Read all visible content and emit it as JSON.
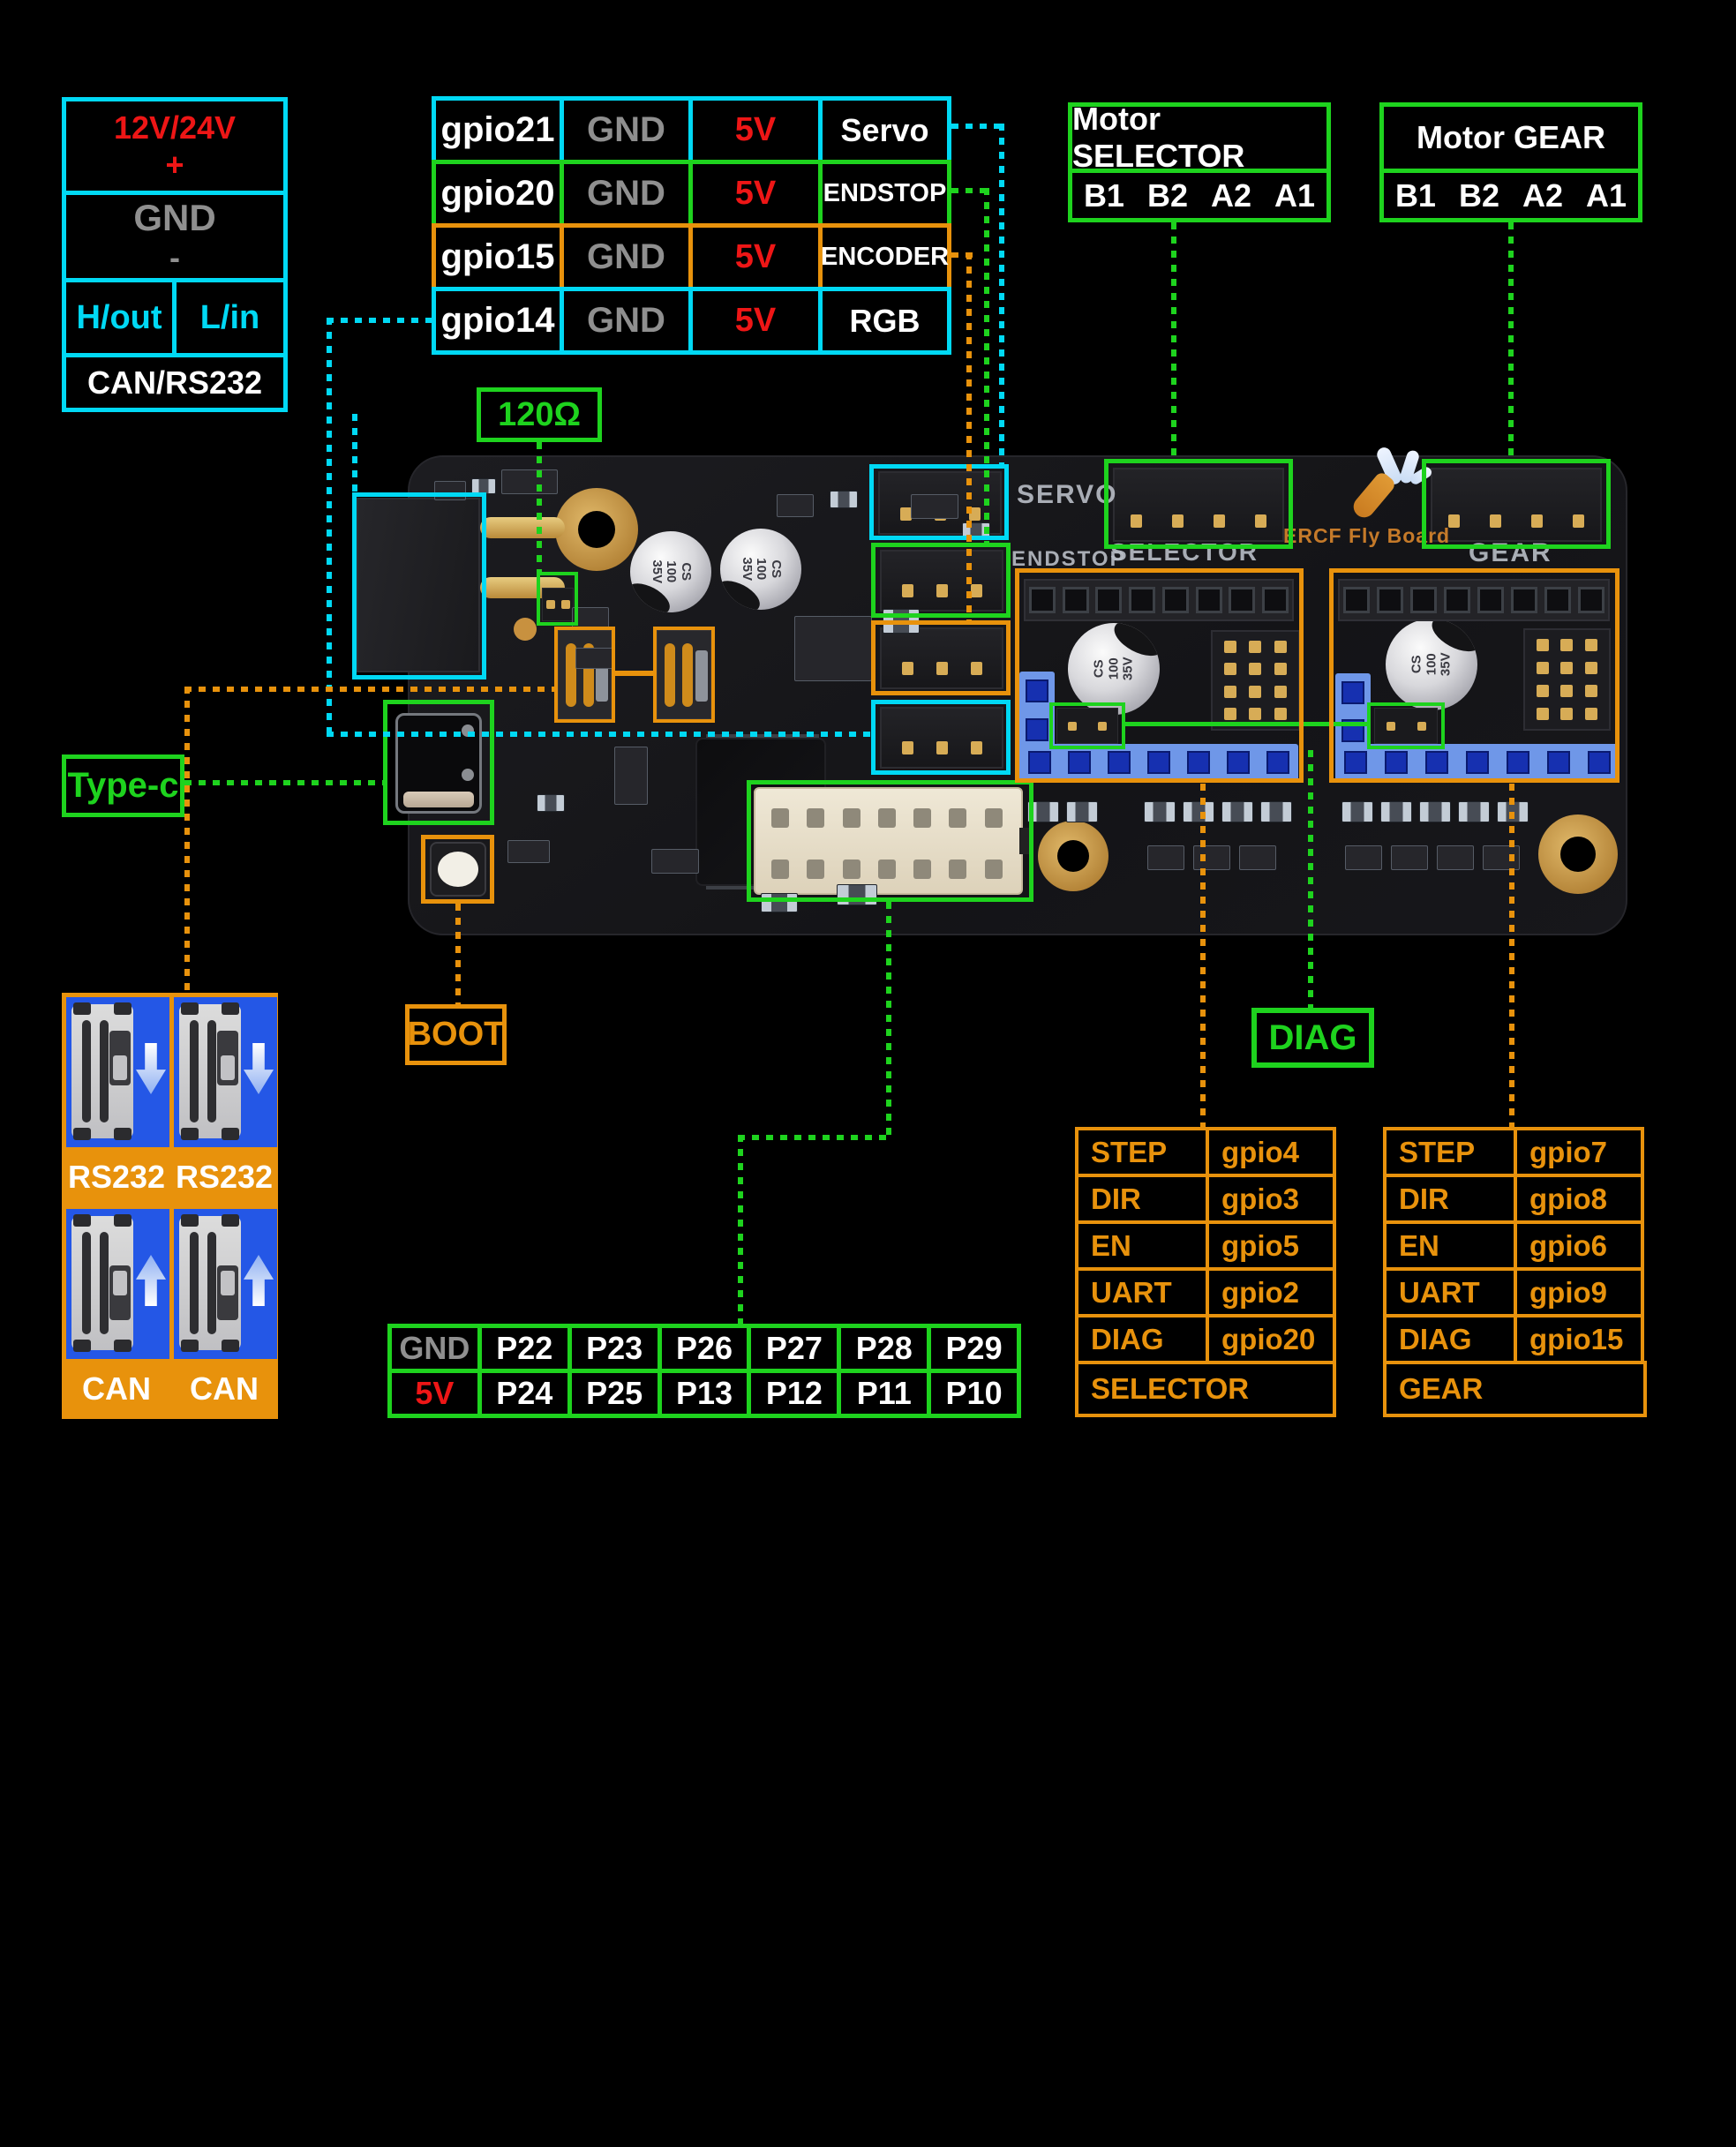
{
  "colors": {
    "cyan": "#00d9f5",
    "green": "#1ed31e",
    "orange": "#e8920c",
    "red": "#ee1616",
    "gray": "#8f8f8f",
    "gold": "#d7ac56",
    "blue-header": "#6f97e8",
    "blue-hole": "#1630b0",
    "panel-blue": "#2457e6",
    "silk": "#b9bec6",
    "brand-orange": "#d9862c"
  },
  "power_box": {
    "voltage": "12V/24V",
    "plus": "+",
    "ground": "GND",
    "minus": "-",
    "high_out": "H/out",
    "low_in": "L/in",
    "protocol": "CAN/RS232"
  },
  "gpio_table": {
    "rows": [
      {
        "gpio": "gpio21",
        "gnd": "GND",
        "v5": "5V",
        "label": "Servo"
      },
      {
        "gpio": "gpio20",
        "gnd": "GND",
        "v5": "5V",
        "label": "ENDSTOP"
      },
      {
        "gpio": "gpio15",
        "gnd": "GND",
        "v5": "5V",
        "label": "ENCODER"
      },
      {
        "gpio": "gpio14",
        "gnd": "GND",
        "v5": "5V",
        "label": "RGB"
      }
    ]
  },
  "motor_selector": {
    "title": "Motor SELECTOR",
    "pins": [
      "B1",
      "B2",
      "A2",
      "A1"
    ]
  },
  "motor_gear": {
    "title": "Motor GEAR",
    "pins": [
      "B1",
      "B2",
      "A2",
      "A1"
    ]
  },
  "callouts": {
    "termination": "120Ω",
    "typec": "Type-c",
    "boot": "BOOT",
    "diag": "DIAG"
  },
  "silkscreen": {
    "servo": "SERVO",
    "endstop": "ENDSTOP",
    "selector": "SELECTOR",
    "gear": "GEAR",
    "brand": "ERCF Fly Board",
    "cap_lines": [
      "CS",
      "100",
      "35V"
    ]
  },
  "comm_panel": {
    "top_labels": [
      "RS232",
      "RS232"
    ],
    "bottom_labels": [
      "CAN",
      "CAN"
    ]
  },
  "aux_pin_table": {
    "row1": [
      "GND",
      "P22",
      "P23",
      "P26",
      "P27",
      "P28",
      "P29"
    ],
    "row2": [
      "5V",
      "P24",
      "P25",
      "P13",
      "P12",
      "P11",
      "P10"
    ]
  },
  "selector_table": {
    "rows": [
      {
        "signal": "STEP",
        "pin": "gpio4"
      },
      {
        "signal": "DIR",
        "pin": "gpio3"
      },
      {
        "signal": "EN",
        "pin": "gpio5"
      },
      {
        "signal": "UART",
        "pin": "gpio2"
      },
      {
        "signal": "DIAG",
        "pin": "gpio20"
      }
    ],
    "footer": "SELECTOR"
  },
  "gear_table": {
    "rows": [
      {
        "signal": "STEP",
        "pin": "gpio7"
      },
      {
        "signal": "DIR",
        "pin": "gpio8"
      },
      {
        "signal": "EN",
        "pin": "gpio6"
      },
      {
        "signal": "UART",
        "pin": "gpio9"
      },
      {
        "signal": "DIAG",
        "pin": "gpio15"
      }
    ],
    "footer": "GEAR"
  }
}
